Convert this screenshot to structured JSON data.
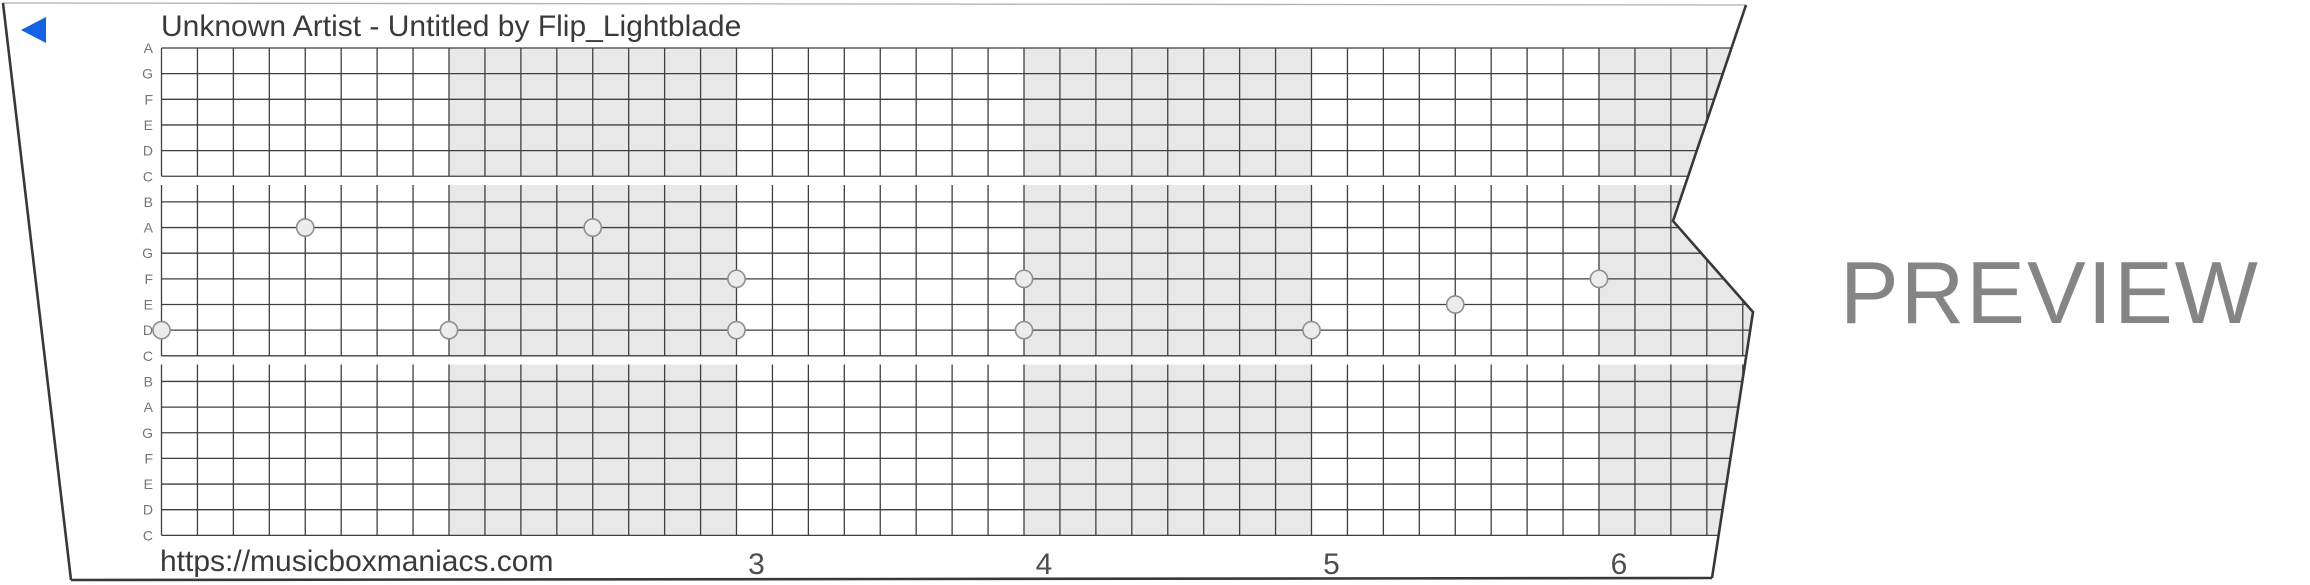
{
  "header": {
    "title": "Unknown Artist - Untitled by Flip_Lightblade"
  },
  "play_button": {
    "color": "#1561e6"
  },
  "watermark": {
    "preview_label": "PREVIEW",
    "color": "#858585"
  },
  "strip": {
    "footer_url": "https://musicboxmaniacs.com",
    "note_labels": [
      "A",
      "G",
      "F",
      "E",
      "D",
      "C",
      "B",
      "A",
      "G",
      "F",
      "E",
      "D",
      "C",
      "B",
      "A",
      "G",
      "F",
      "E",
      "D",
      "C"
    ],
    "measure_numbers": [
      {
        "label": "3",
        "measure": 3
      },
      {
        "label": "4",
        "measure": 4
      },
      {
        "label": "5",
        "measure": 5
      },
      {
        "label": "6",
        "measure": 6
      }
    ],
    "shaded_measures": [
      2,
      4,
      6
    ],
    "beats_per_measure": 8,
    "melody": [
      {
        "beat": 0,
        "note": "D",
        "line_index": 11
      },
      {
        "beat": 4,
        "note": "A",
        "line_index": 7
      },
      {
        "beat": 8,
        "note": "D",
        "line_index": 11
      },
      {
        "beat": 12,
        "note": "A",
        "line_index": 7
      },
      {
        "beat": 16,
        "note": "F",
        "line_index": 9
      },
      {
        "beat": 16,
        "note": "D",
        "line_index": 11
      },
      {
        "beat": 24,
        "note": "F",
        "line_index": 9
      },
      {
        "beat": 24,
        "note": "D",
        "line_index": 11
      },
      {
        "beat": 32,
        "note": "D",
        "line_index": 11
      },
      {
        "beat": 36,
        "note": "E",
        "line_index": 10
      },
      {
        "beat": 40,
        "note": "F",
        "line_index": 9
      }
    ],
    "colors": {
      "grid_line": "#3f3f3f",
      "measure_shade": "#e9e8e8",
      "dot_fill": "#ececec",
      "dot_stroke": "#8f8f8f",
      "edge_dark": "#383838",
      "edge_top": "#b0b0b0",
      "title_text": "#3a3a3a",
      "number_text": "#4d4d4d",
      "label_text": "#757575"
    }
  }
}
